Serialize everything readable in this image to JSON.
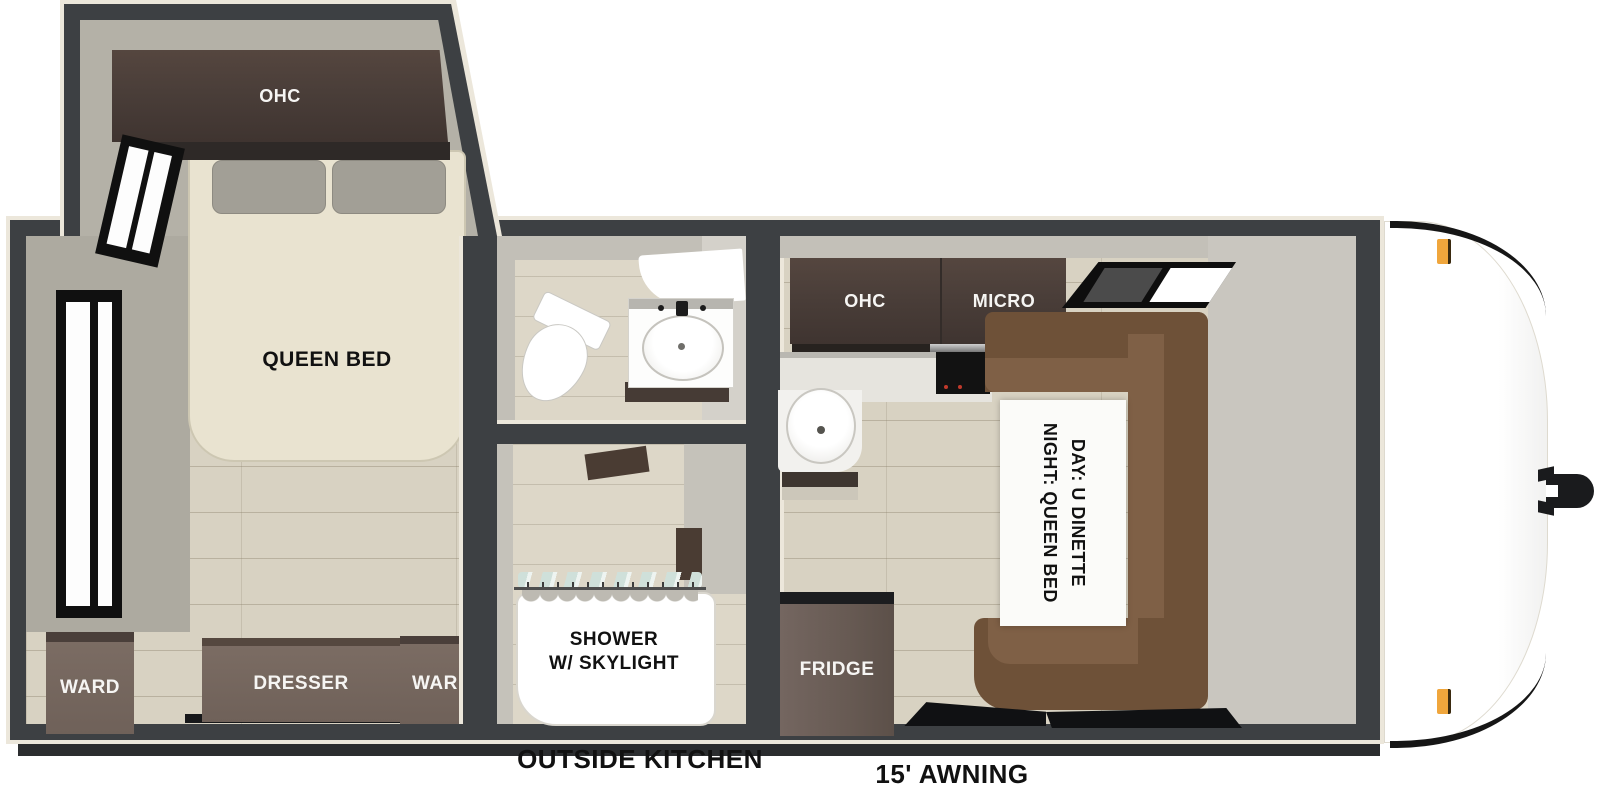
{
  "floorplan": {
    "labels": {
      "ohc_bedroom": "OHC",
      "queen_bed": "QUEEN BED",
      "ward_left": "WARD",
      "dresser": "DRESSER",
      "ward_right": "WARD",
      "shower_line1": "SHOWER",
      "shower_line2": "W/ SKYLIGHT",
      "ohc_kitchen": "OHC",
      "micro": "MICRO",
      "fridge": "FRIDGE",
      "dinette_line1": "DAY: U DINETTE",
      "dinette_line2": "NIGHT: QUEEN BED",
      "outside_kitchen": "OUTSIDE KITCHEN",
      "awning": "15' AWNING"
    },
    "colors": {
      "wall": "#3d4043",
      "trim": "#ece7db",
      "floor_wood": "#d8d2c2",
      "cabinet_brown": "#4a3e39",
      "furniture_brown": "#6f6159",
      "dinette_brown": "#6e5138",
      "bed_cream": "#e9e3d0",
      "marker_amber": "#f0a63c"
    }
  }
}
